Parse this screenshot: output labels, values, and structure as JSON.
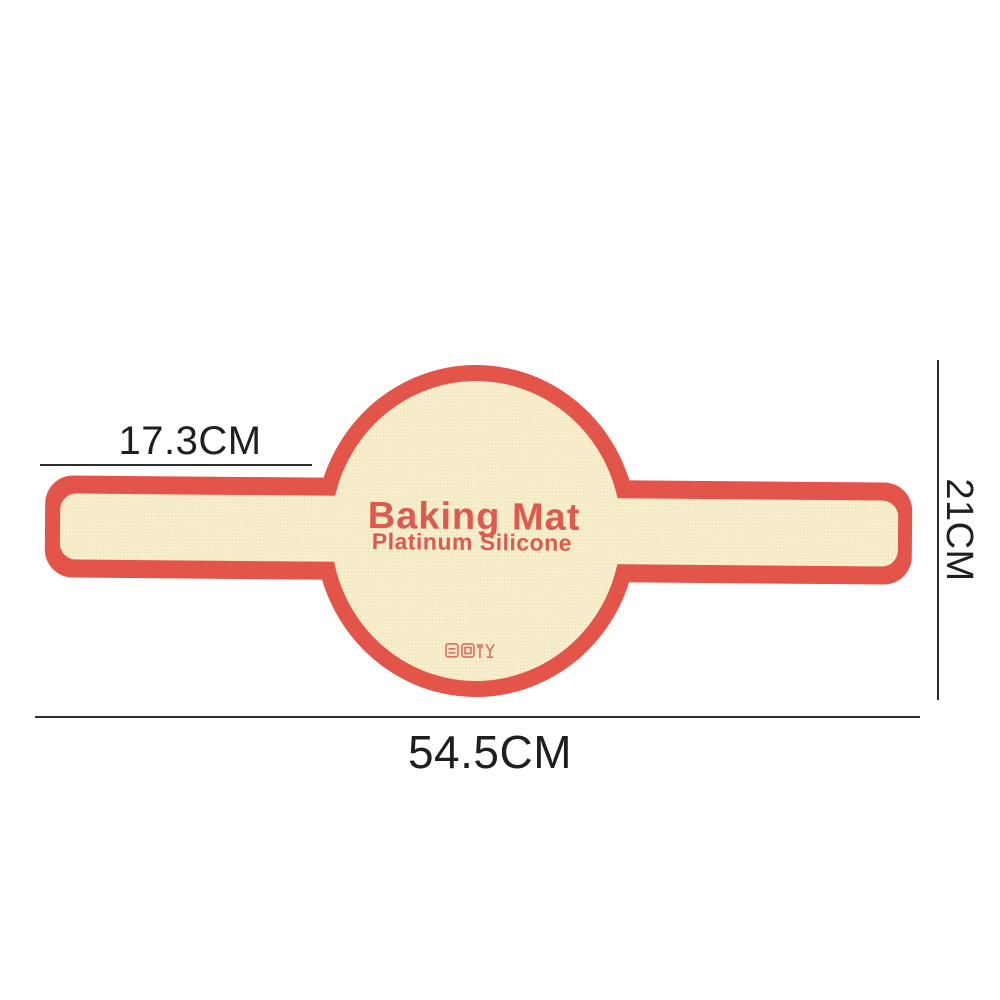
{
  "background_color": "#ffffff",
  "product": {
    "name": "Baking Mat",
    "material": "Platinum Silicone",
    "border_color": "#e4544a",
    "surface_color": "#f7eecc",
    "print_color": "#dd5a4f",
    "certification_icons": [
      "square-cert-icon",
      "square-grid-cert-icon",
      "food-safe-glass-fork-icon"
    ]
  },
  "annotations": {
    "line_color": "#2d2d2d",
    "left_section_width_label": "17.3CM",
    "height_label": "21CM",
    "total_length_label": "54.5CM"
  }
}
